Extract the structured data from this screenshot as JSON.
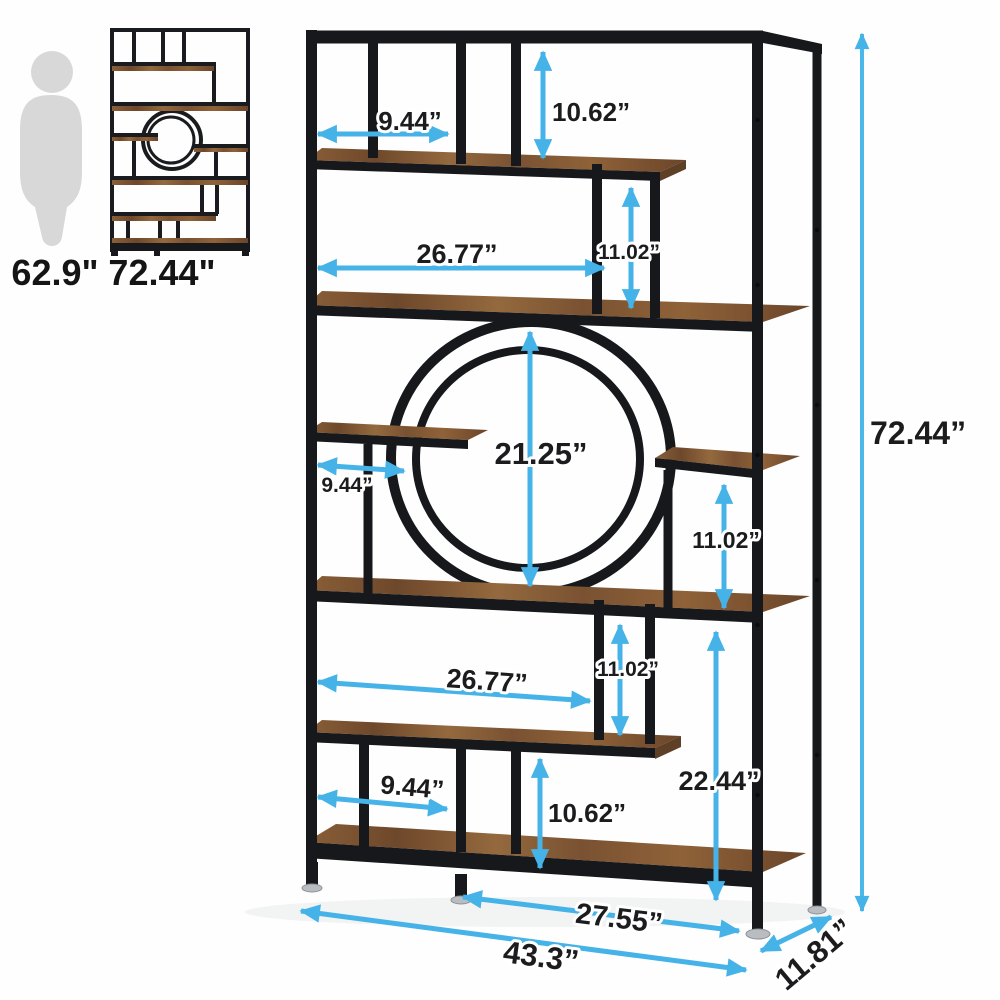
{
  "diagram": {
    "type": "product-dimension-diagram",
    "background": "#fefefe",
    "accent_color": "#45b3e8",
    "frame_color": "#17181b",
    "wood_color": "#7c5636",
    "silhouette_color": "#d8d8d8",
    "label_color": "#1c1c1e"
  },
  "scale_reference": {
    "person_height": "62.9\"",
    "product_height": "72.44\""
  },
  "dimensions": {
    "top_cubby_width": "9.44”",
    "top_cubby_height": "10.62”",
    "upper_opening_width": "26.77”",
    "upper_step_height": "11.02”",
    "circle_opening_height": "21.25”",
    "middle_shelf_width": "9.44”",
    "middle_right_opening_height": "11.02”",
    "lower_opening_width": "26.77”",
    "lower_step_height": "11.02”",
    "bottom_cubby_height": "10.62”",
    "bottom_cubby_width": "9.44”",
    "lower_right_opening_height": "22.44”",
    "bottom_shelf_width": "27.55”",
    "overall_width": "43.3”",
    "overall_depth": "11.81”",
    "overall_height": "72.44”"
  }
}
